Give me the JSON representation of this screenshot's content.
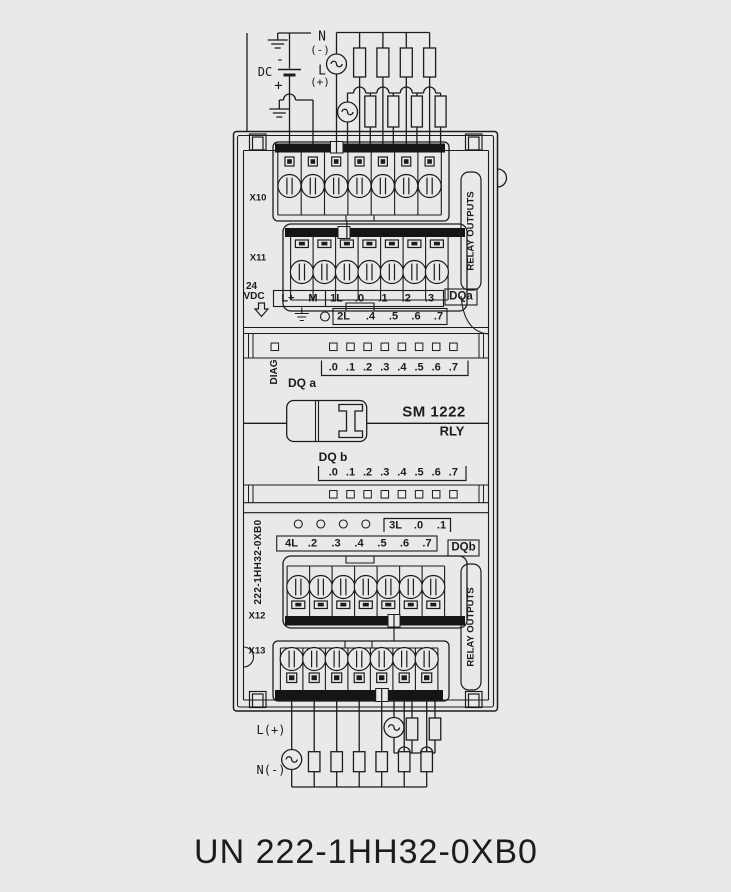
{
  "colors": {
    "background": "#e9e9e9",
    "ink": "#1c1c1c"
  },
  "title": "UN 222-1HH32-0XB0",
  "wiring_top": {
    "n": "N",
    "n_polarity": "(-)",
    "l": "L",
    "l_polarity": "(+)",
    "dc": "DC",
    "minus": "-",
    "plus": "+"
  },
  "wiring_bottom": {
    "l_plus": "L(+)",
    "n_minus": "N(-)"
  },
  "module": {
    "connector_x10": "X10",
    "connector_x11": "X11",
    "connector_x12": "X12",
    "connector_x13": "X13",
    "supply_voltage": "24",
    "supply_unit": "VDC",
    "row_a": [
      "L+",
      "M",
      "1L",
      ".0",
      ".1",
      ".2",
      ".3"
    ],
    "dqa_group": "DQa",
    "row_b": [
      "2L",
      ".4",
      ".5",
      ".6",
      ".7"
    ],
    "diag": "DIAG",
    "channels": [
      ".0",
      ".1",
      ".2",
      ".3",
      ".4",
      ".5",
      ".6",
      ".7"
    ],
    "dq_a": "DQ a",
    "product": "SM 1222",
    "product_type": "RLY",
    "dq_b": "DQ b",
    "row_c": [
      "3L",
      ".0",
      ".1"
    ],
    "row_d": [
      "4L",
      ".2",
      ".3",
      ".4",
      ".5",
      ".6",
      ".7"
    ],
    "dqb_group": "DQb",
    "order_number": "222-1HH32-0XB0",
    "relay_outputs": "RELAY OUTPUTS"
  }
}
